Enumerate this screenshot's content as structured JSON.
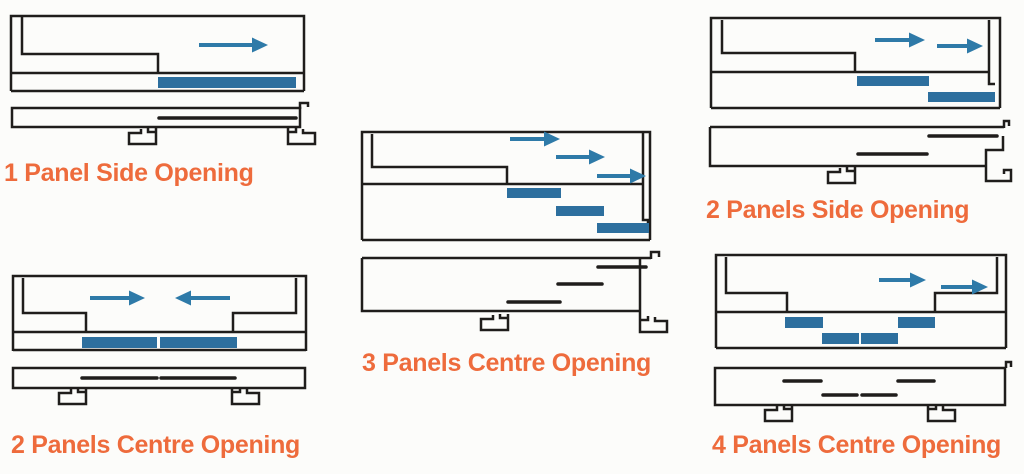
{
  "page": {
    "background": "#fcfcfa"
  },
  "colors": {
    "line": "#1f1d1b",
    "panel": "#2d6f9e",
    "arrow": "#2e7aa8",
    "label": "#ee6b3c"
  },
  "diagrams": [
    {
      "id": "1-panel-side-opening",
      "label": "1 Panel Side Opening",
      "panel_count": 1,
      "opening_type": "side",
      "frame_paths": [
        "M11 91 V16 H304 V91",
        "M11 73 H304",
        "M11 91 H304",
        "M22 17 V54 H158 V74"
      ],
      "panels": [
        {
          "x": 158,
          "y": 77,
          "w": 138,
          "h": 11
        }
      ],
      "arrows": [
        {
          "x1": 199,
          "y": 45,
          "x2": 268
        }
      ],
      "section_paths": [
        "M12 108 H300 V127 H12 Z",
        "M300 109 V103 H308 V107"
      ],
      "section_lines": [
        {
          "x1": 159,
          "y": 118,
          "x2": 296
        }
      ],
      "hooks": [
        {
          "x": 156,
          "y": 128,
          "m": 0
        },
        {
          "x": 288,
          "y": 128,
          "m": 1
        }
      ]
    },
    {
      "id": "2-panels-centre-opening",
      "label": "2 Panels Centre Opening",
      "panel_count": 2,
      "opening_type": "centre",
      "frame_paths": [
        "M13 351 V276 H306 V351",
        "M13 332 H306",
        "M13 350 H306",
        "M23 278 V313 H86 V333",
        "M296 278 V313 H233 V333"
      ],
      "panels": [
        {
          "x": 82,
          "y": 337,
          "w": 75,
          "h": 11
        },
        {
          "x": 160,
          "y": 337,
          "w": 77,
          "h": 11
        }
      ],
      "arrows": [
        {
          "x1": 90,
          "y": 298,
          "x2": 145
        },
        {
          "x1": 230,
          "y": 298,
          "x2": 175
        }
      ],
      "section_paths": [
        "M13 368 H305 V388 H13 Z"
      ],
      "section_lines": [
        {
          "x1": 82,
          "y": 378,
          "x2": 157
        },
        {
          "x1": 161,
          "y": 378,
          "x2": 235
        }
      ],
      "hooks": [
        {
          "x": 86,
          "y": 388,
          "m": 0
        },
        {
          "x": 232,
          "y": 388,
          "m": 1
        }
      ]
    },
    {
      "id": "3-panels-centre-opening",
      "label": "3 Panels Centre Opening",
      "panel_count": 3,
      "opening_type": "centre",
      "frame_paths": [
        "M362 240 V132 H650 V240",
        "M362 240 H650",
        "M362 184 H643",
        "M372 134 V167 H507 V184",
        "M643 132 V220 H648 V227"
      ],
      "panels": [
        {
          "x": 507,
          "y": 188,
          "w": 54,
          "h": 10
        },
        {
          "x": 556,
          "y": 206,
          "w": 48,
          "h": 10
        },
        {
          "x": 597,
          "y": 223,
          "w": 52,
          "h": 10
        }
      ],
      "arrows": [
        {
          "x1": 510,
          "y": 139,
          "x2": 560
        },
        {
          "x1": 556,
          "y": 157,
          "x2": 605
        },
        {
          "x1": 597,
          "y": 176,
          "x2": 646
        }
      ],
      "section_paths": [
        "M362 258 H651",
        "M651 259 V252 H659 V257",
        "M362 258 V311 H640",
        "M640 259 V316"
      ],
      "section_lines": [
        {
          "x1": 598,
          "y": 267,
          "x2": 646
        },
        {
          "x1": 558,
          "y": 284,
          "x2": 602
        },
        {
          "x1": 508,
          "y": 302,
          "x2": 560
        }
      ],
      "hooks": [
        {
          "x": 508,
          "y": 314,
          "m": 0
        },
        {
          "x": 640,
          "y": 316,
          "m": 1
        }
      ]
    },
    {
      "id": "2-panels-side-opening",
      "label": "2 Panels Side Opening",
      "panel_count": 2,
      "opening_type": "side",
      "frame_paths": [
        "M711 108 V18 H1000 V108",
        "M711 108 H1000",
        "M711 72 H989",
        "M722 20 V53 H855 V72",
        "M989 20 V84 H995"
      ],
      "panels": [
        {
          "x": 857,
          "y": 76,
          "w": 72,
          "h": 10
        },
        {
          "x": 928,
          "y": 92,
          "w": 67,
          "h": 10
        }
      ],
      "arrows": [
        {
          "x1": 875,
          "y": 40,
          "x2": 925
        },
        {
          "x1": 937,
          "y": 46,
          "x2": 983
        }
      ],
      "section_paths": [
        "M710 127 H1004",
        "M1004 128 V121 H1009 V126",
        "M710 127 V166 H986",
        "M1003 136 V150 H986 V181 H1011 V170 H1004 V174"
      ],
      "section_lines": [
        {
          "x1": 929,
          "y": 136,
          "x2": 997
        },
        {
          "x1": 858,
          "y": 154,
          "x2": 927
        }
      ],
      "hooks": [
        {
          "x": 855,
          "y": 167,
          "m": 0
        }
      ]
    },
    {
      "id": "4-panels-centre-opening",
      "label": "4 Panels Centre Opening",
      "panel_count": 4,
      "opening_type": "centre",
      "frame_paths": [
        "M716 348 V255 H1006 V348",
        "M716 348 H1006",
        "M716 312 H1006",
        "M726 257 V293 H787 V312",
        "M997 257 V293 H935 V312"
      ],
      "panels": [
        {
          "x": 785,
          "y": 317,
          "w": 38,
          "h": 11
        },
        {
          "x": 898,
          "y": 317,
          "w": 37,
          "h": 11
        },
        {
          "x": 822,
          "y": 333,
          "w": 37,
          "h": 11
        },
        {
          "x": 861,
          "y": 333,
          "w": 37,
          "h": 11
        }
      ],
      "arrows": [
        {
          "x1": 879,
          "y": 280,
          "x2": 926
        },
        {
          "x1": 941,
          "y": 287,
          "x2": 988
        }
      ],
      "section_paths": [
        "M715 368 H1005 V405 H715 Z",
        "M1006 368 V362 H1011 V367"
      ],
      "section_lines": [
        {
          "x1": 784,
          "y": 381,
          "x2": 821
        },
        {
          "x1": 898,
          "y": 381,
          "x2": 934
        },
        {
          "x1": 823,
          "y": 395,
          "x2": 857
        },
        {
          "x1": 862,
          "y": 395,
          "x2": 896
        }
      ],
      "hooks": [
        {
          "x": 792,
          "y": 405,
          "m": 0
        },
        {
          "x": 928,
          "y": 405,
          "m": 1
        }
      ]
    }
  ]
}
